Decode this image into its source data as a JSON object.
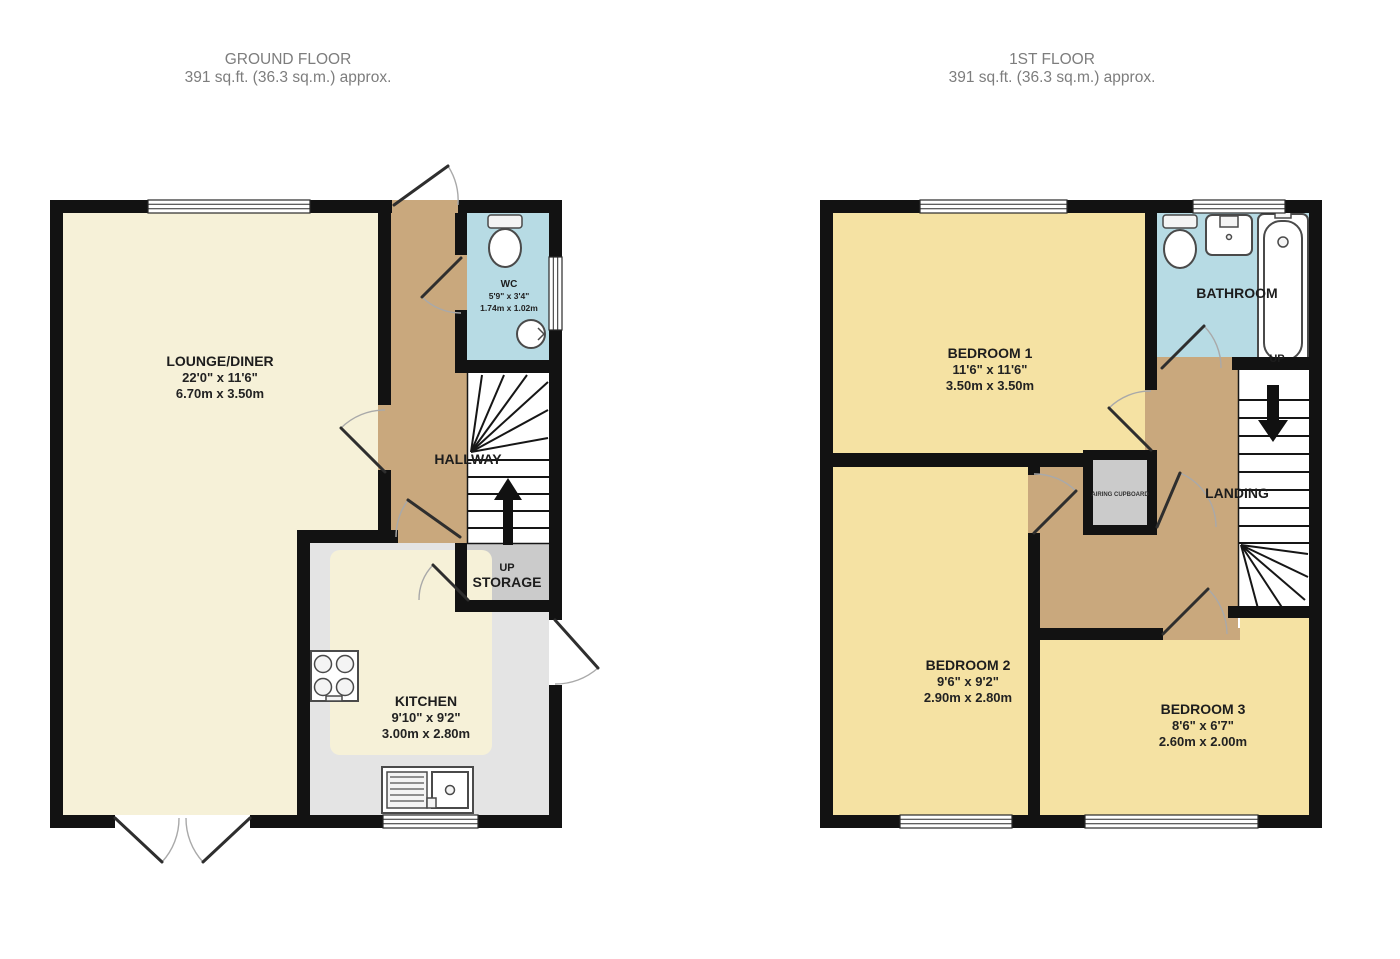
{
  "ground_floor": {
    "title": "GROUND FLOOR",
    "subtitle": "391 sq.ft. (36.3 sq.m.) approx.",
    "rooms": {
      "lounge_diner": {
        "name": "LOUNGE/DINER",
        "size_imperial": "22'0\" x 11'6\"",
        "size_metric": "6.70m x 3.50m"
      },
      "wc": {
        "name": "WC",
        "size_imperial": "5'9\" x 3'4\"",
        "size_metric": "1.74m x 1.02m"
      },
      "hallway": {
        "name": "HALLWAY"
      },
      "storage": {
        "name": "STORAGE",
        "up_label": "UP"
      },
      "kitchen": {
        "name": "KITCHEN",
        "size_imperial": "9'10\" x 9'2\"",
        "size_metric": "3.00m x 2.80m"
      }
    }
  },
  "first_floor": {
    "title": "1ST FLOOR",
    "subtitle": "391 sq.ft. (36.3 sq.m.) approx.",
    "rooms": {
      "bedroom1": {
        "name": "BEDROOM 1",
        "size_imperial": "11'6\" x 11'6\"",
        "size_metric": "3.50m x 3.50m"
      },
      "bedroom2": {
        "name": "BEDROOM 2",
        "size_imperial": "9'6\" x 9'2\"",
        "size_metric": "2.90m x 2.80m"
      },
      "bedroom3": {
        "name": "BEDROOM 3",
        "size_imperial": "8'6\" x 6'7\"",
        "size_metric": "2.60m x 2.00m"
      },
      "bathroom": {
        "name": "BATHROOM",
        "up_label": "UP"
      },
      "landing": {
        "name": "LANDING"
      },
      "airing_cupboard": {
        "name": "AIRING CUPBOARD"
      }
    }
  },
  "colors": {
    "wall": "#121212",
    "cream_floor": "#f6f1d8",
    "bedroom_floor": "#f5e2a3",
    "hall_floor": "#c9a87d",
    "bath_floor": "#b7dbe4",
    "storage_floor": "#cbcbcb",
    "kitchen_counter": "#e4e4e4",
    "stairs": "#ffffff",
    "title_text": "#7d7d7d",
    "label_text": "#1d1d1d"
  }
}
